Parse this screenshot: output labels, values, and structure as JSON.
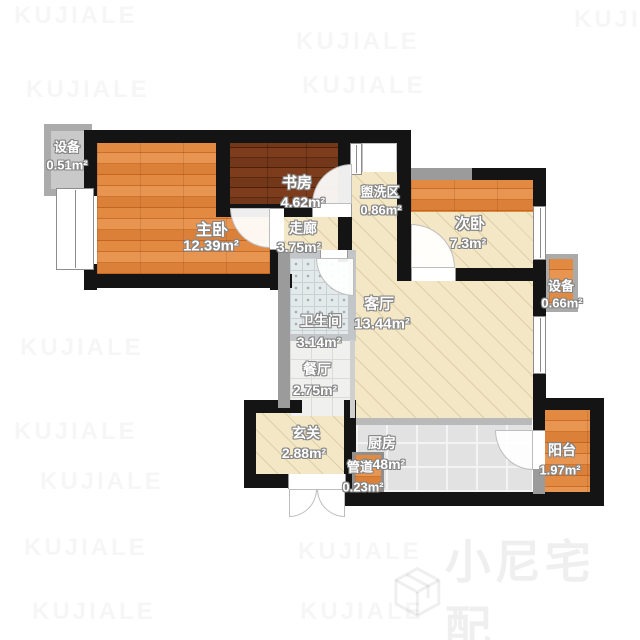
{
  "watermark": {
    "text": "KUJIALE"
  },
  "brand": {
    "name": "小尼宅配",
    "icon": "cube-logo-icon"
  },
  "rooms": {
    "master": {
      "name": "主卧",
      "area": "12.39m²"
    },
    "study": {
      "name": "书房",
      "area": "4.62m²"
    },
    "washing": {
      "name": "盥洗区",
      "area": "0.86m²"
    },
    "second": {
      "name": "次卧",
      "area": "7.3m²"
    },
    "corridor": {
      "name": "走廊",
      "area": "3.75m²"
    },
    "living": {
      "name": "客厅",
      "area": "13.44m²"
    },
    "bathroom": {
      "name": "卫生间",
      "area": "3.14m²"
    },
    "dining": {
      "name": "餐厅",
      "area": "2.75m²"
    },
    "entrance": {
      "name": "玄关",
      "area": "2.88m²"
    },
    "kitchen": {
      "name": "厨房",
      "area": "6.48m²"
    },
    "pipe": {
      "name": "管道",
      "area": "0.23m²"
    },
    "balcony": {
      "name": "阳台",
      "area": "1.97m²"
    },
    "equipLeft": {
      "name": "设备",
      "area": "0.51m²"
    },
    "equipRight": {
      "name": "设备",
      "area": "0.66m²"
    }
  },
  "colors": {
    "wall": "#141414",
    "wall_secondary": "#9b9b9b",
    "wood_warm": "#dd8038",
    "wood_dark": "#6c3317",
    "floor_beige": "#f3e7c6",
    "tile_bath": "#e4e9ea",
    "tile_kitchen": "#e2e2e2"
  }
}
